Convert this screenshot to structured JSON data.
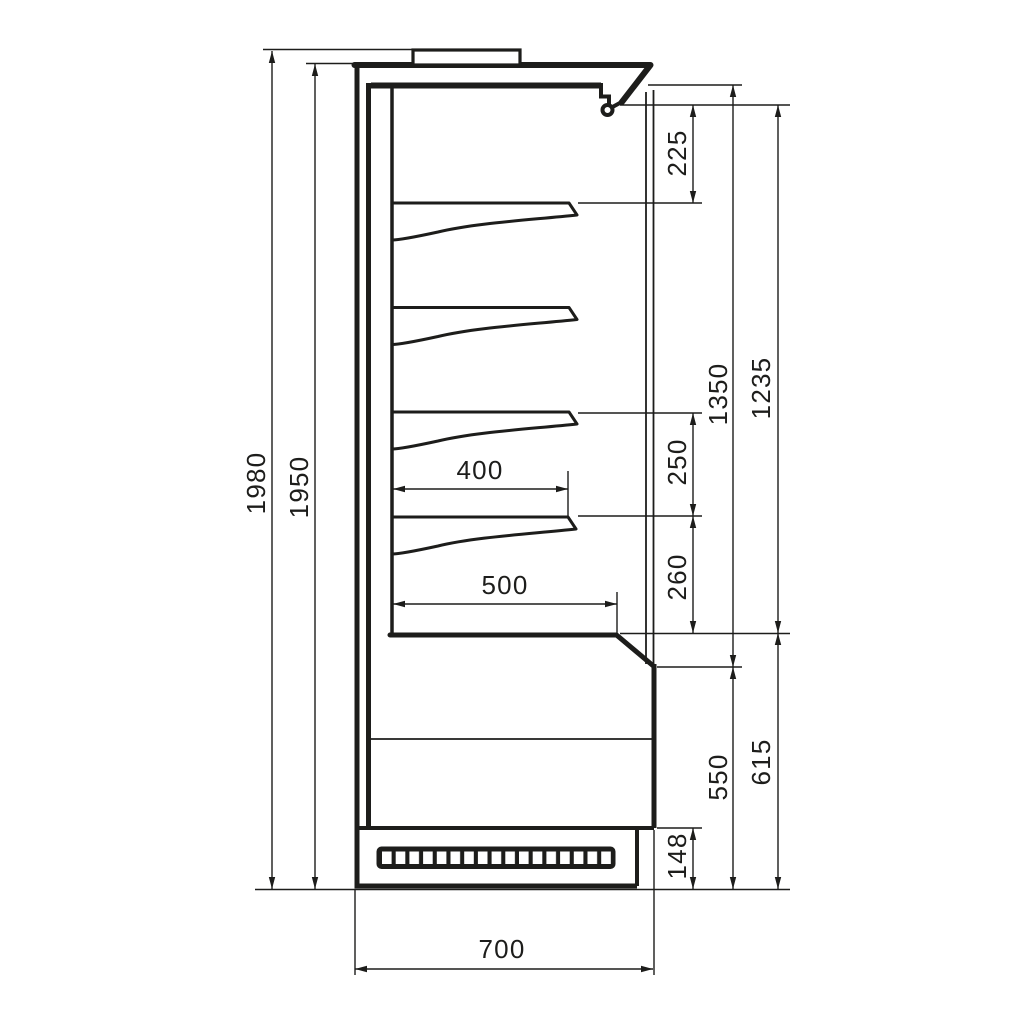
{
  "drawing": {
    "background": "#ffffff",
    "line_color": "#1d1d1b",
    "dims": {
      "overall_height": "1980",
      "body_height": "1950",
      "canopy_to_first_shelf": "225",
      "interior_height": "1350",
      "opening_height": "1235",
      "shelf_spacing": "250",
      "shelf_to_deck": "260",
      "shelf_depth": "400",
      "deck_depth": "500",
      "base_front_height": "550",
      "base_total_height": "615",
      "plinth_height": "148",
      "overall_depth": "700"
    }
  }
}
